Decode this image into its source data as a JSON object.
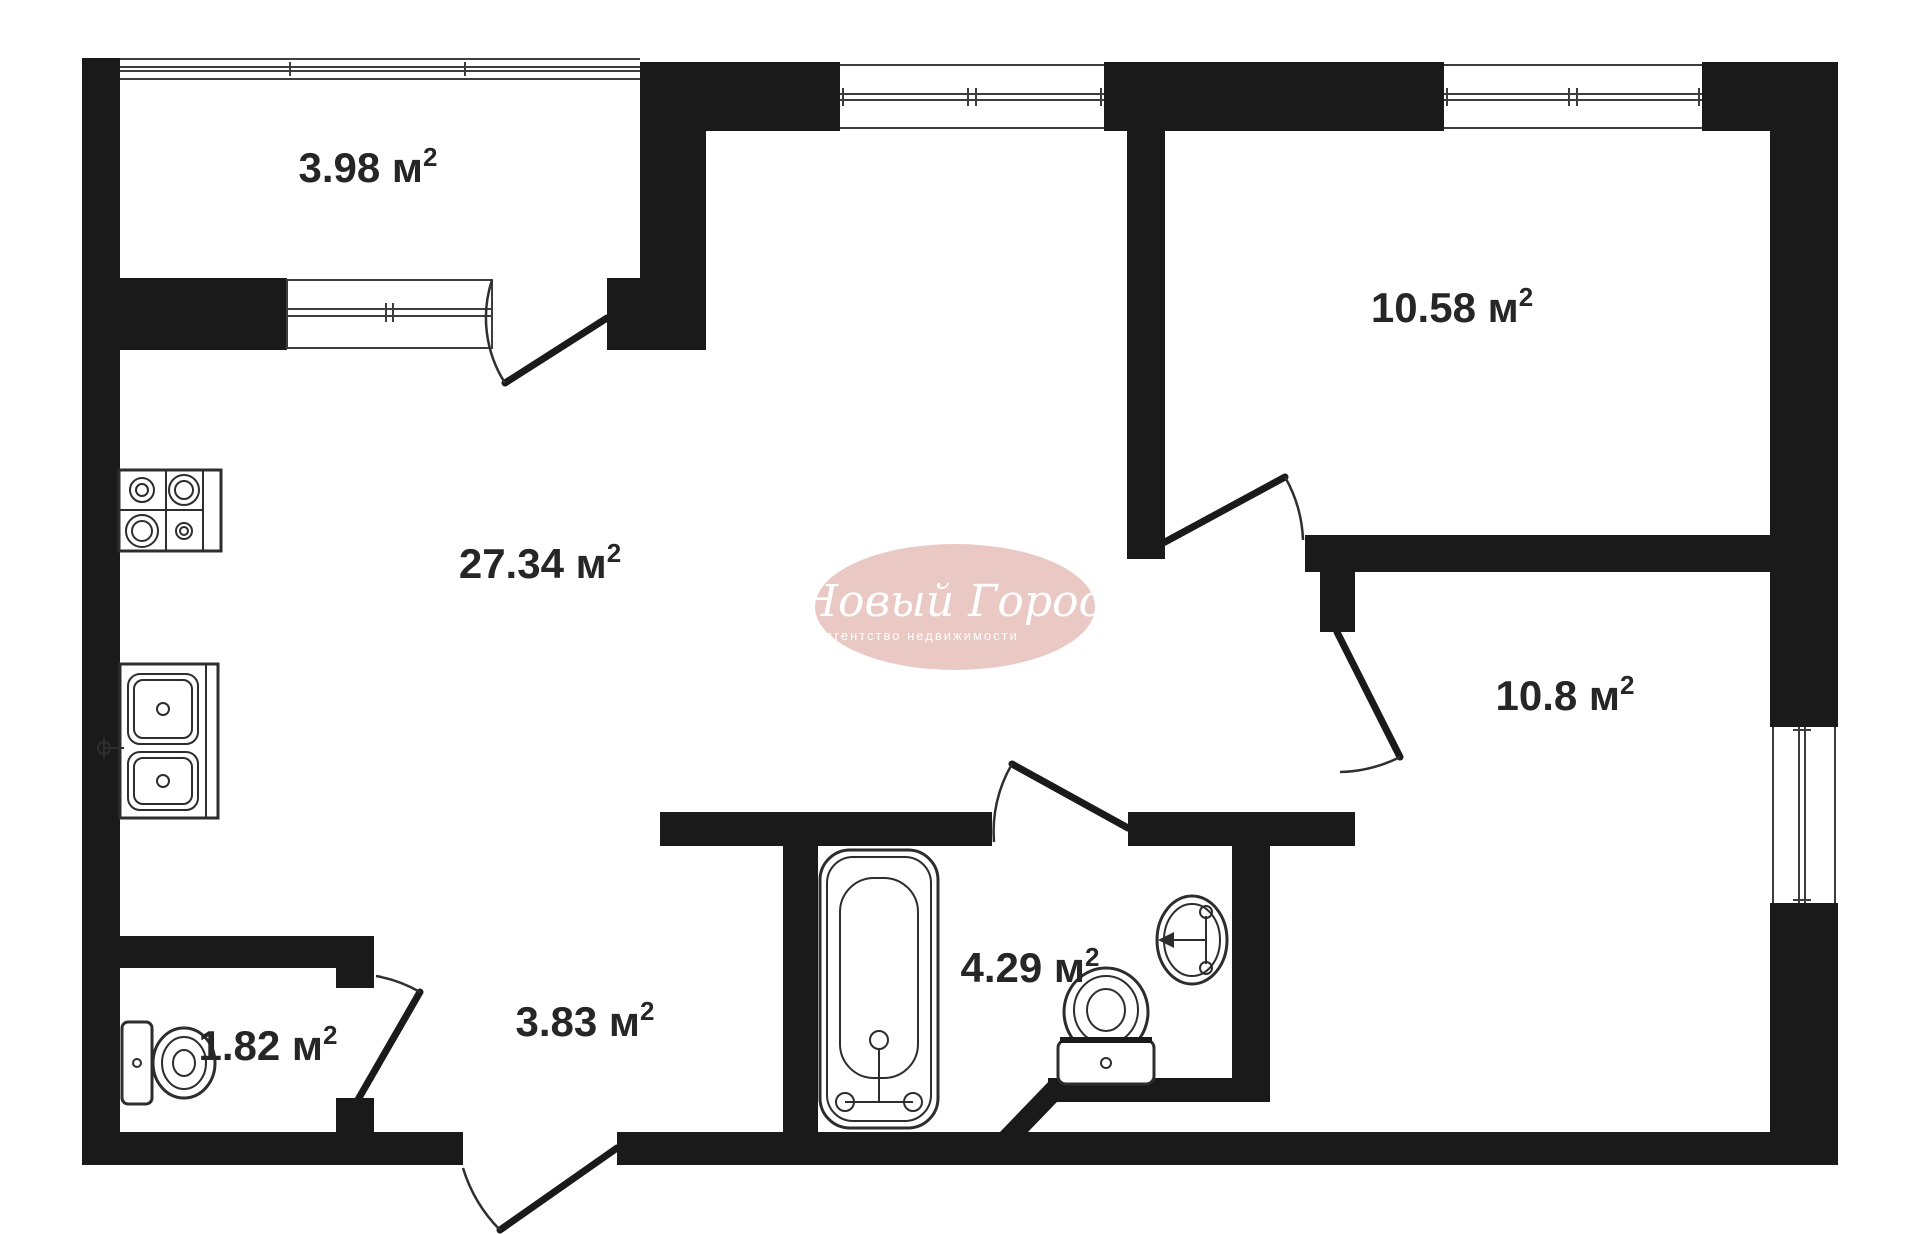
{
  "plan": {
    "type": "apartment-floor-plan",
    "unit": "м²",
    "sup": "2"
  },
  "rooms": [
    {
      "id": "balcony",
      "area": "3.98",
      "area_label": "3.98 м"
    },
    {
      "id": "living-kitchen",
      "area": "27.34",
      "area_label": "27.34 м"
    },
    {
      "id": "bedroom-top",
      "area": "10.58",
      "area_label": "10.58 м"
    },
    {
      "id": "bedroom-right",
      "area": "10.8",
      "area_label": "10.8 м"
    },
    {
      "id": "bathroom",
      "area": "4.29",
      "area_label": "4.29 м"
    },
    {
      "id": "hallway",
      "area": "3.83",
      "area_label": "3.83 м"
    },
    {
      "id": "wc",
      "area": "1.82",
      "area_label": "1.82 м"
    }
  ],
  "watermark": {
    "brand": "Новый Город",
    "tagline": "агентство недвижимости"
  },
  "fixtures": [
    "stove-icon",
    "kitchen-sink-icon",
    "toilet-icon",
    "bathtub-icon",
    "washbasin-icon"
  ],
  "colors": {
    "wall": "#1a1a1a",
    "line": "#3d3d3d",
    "background": "#ffffff",
    "watermark_bg": "#e8c5c0",
    "watermark_text": "#ffffff",
    "label": "#262626"
  }
}
